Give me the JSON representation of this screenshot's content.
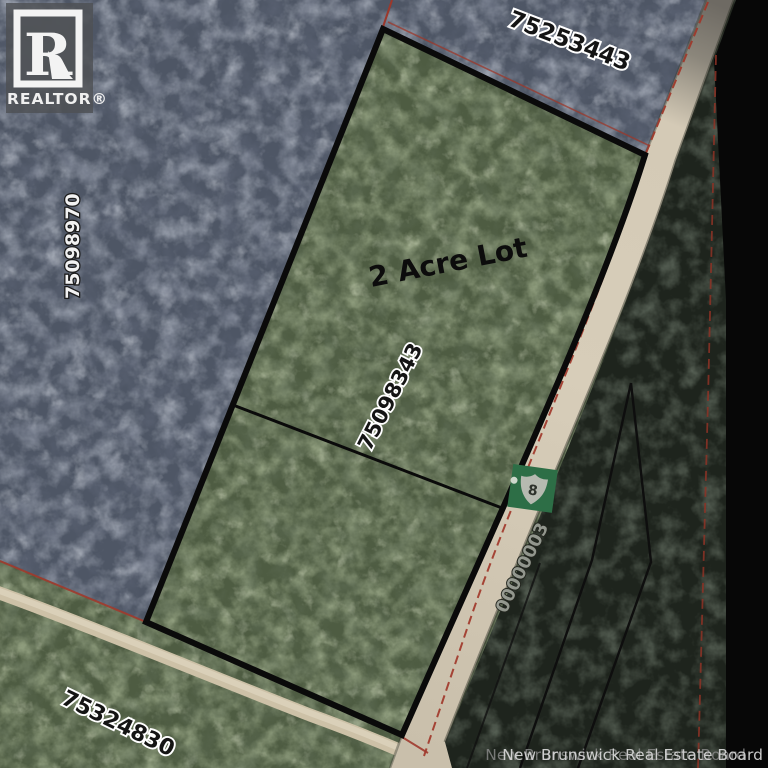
{
  "branding": {
    "logo_letter": "R",
    "logo_text": "REALTOR®"
  },
  "lot_label": "2 Acre Lot",
  "parcel_labels": {
    "top_right": "75253443",
    "west": "75098970",
    "center": "75098343",
    "south_west": "75324830",
    "road_parcel": "00000003"
  },
  "route_shield": {
    "number": "8"
  },
  "watermark": {
    "text": "New Brunswick Real Estate Board"
  },
  "colors": {
    "boundary_black": "#0a0a0a",
    "cadastral_red": "#9c382b",
    "route_shield_green": "#2d6e46",
    "road_tan": "#d6ccb8",
    "shadow_forest_blue": "#4e5665",
    "forest_green": "#4e5c42",
    "watermark_gray": "#d9d9d9"
  }
}
